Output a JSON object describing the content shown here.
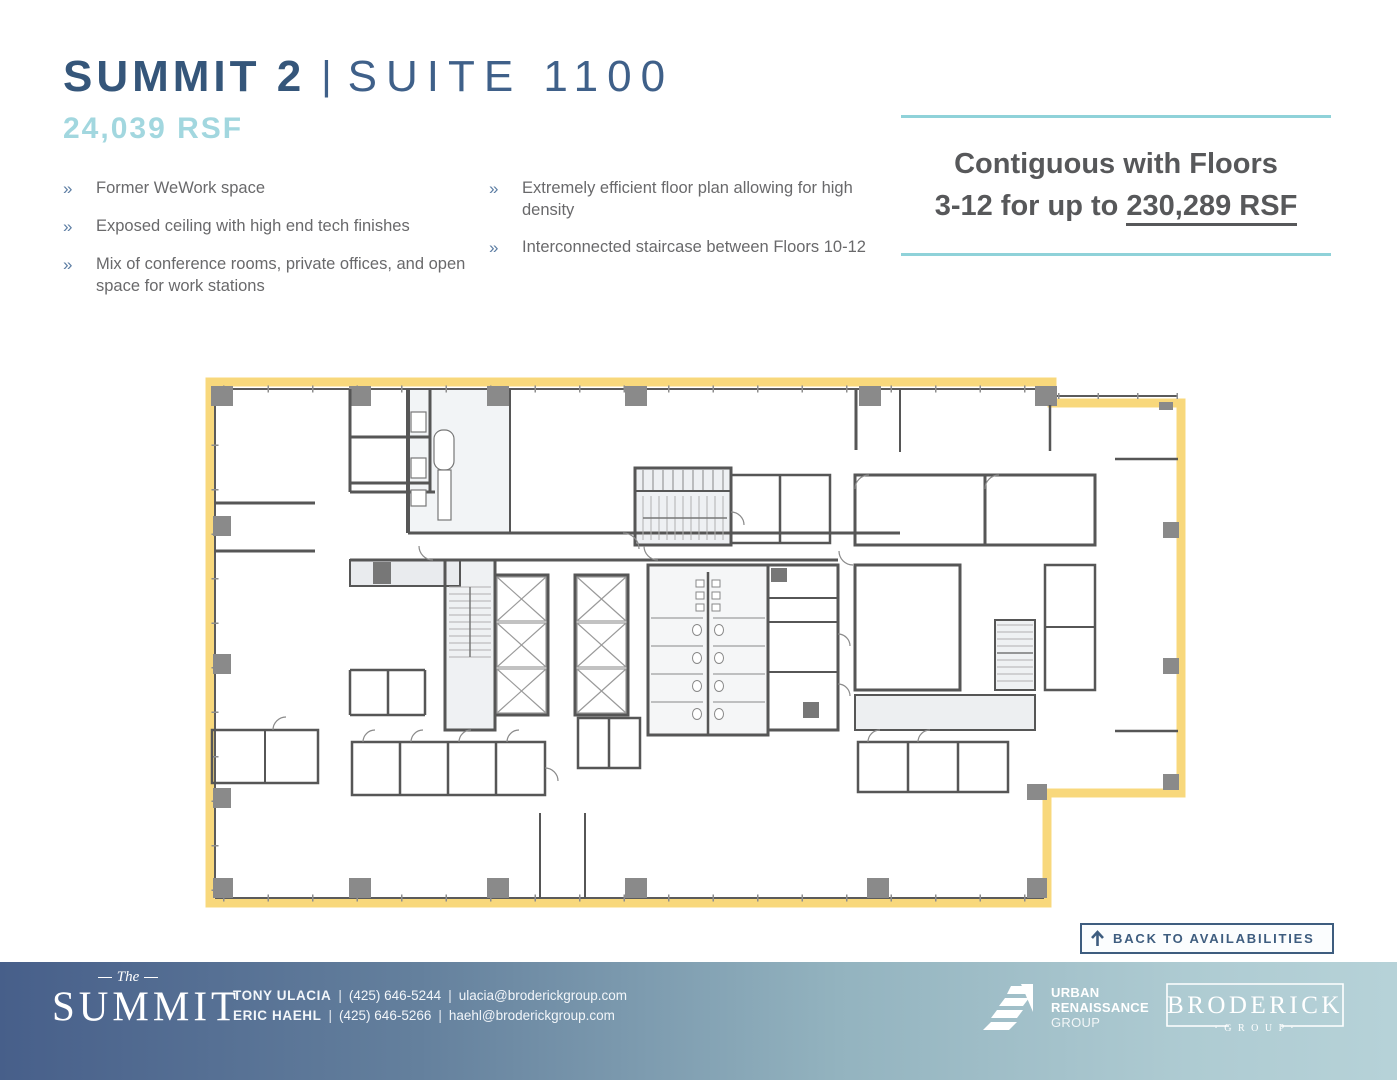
{
  "header": {
    "building": "SUMMIT 2",
    "separator": "|",
    "suite": "SUITE 1100",
    "size": "24,039 RSF"
  },
  "features": {
    "marker": "»",
    "left": [
      "Former WeWork space",
      "Exposed ceiling with high end tech finishes",
      "Mix of conference rooms, private offices, and open space for work stations"
    ],
    "right": [
      "Extremely efficient floor plan allowing for high density",
      "Interconnected staircase between Floors 10-12"
    ]
  },
  "callout": {
    "line1": "Contiguous with Floors",
    "line2_prefix": "3-12 for up to ",
    "line2_highlight": "230,289 RSF"
  },
  "floor_plan": {
    "highlight_color": "#f8d87c",
    "wall_color": "#565656",
    "column_color": "#8a8a8a"
  },
  "back_button": {
    "label": "BACK TO AVAILABILITIES"
  },
  "footer": {
    "separator": "|",
    "summit_logo": {
      "script": "The",
      "name": "SUMMIT"
    },
    "contacts": [
      {
        "name": "TONY ULACIA",
        "phone": "(425) 646-5244",
        "email": "ulacia@broderickgroup.com"
      },
      {
        "name": "ERIC HAEHL",
        "phone": "(425) 646-5266",
        "email": "haehl@broderickgroup.com"
      }
    ],
    "urban_renaissance_logo": {
      "line1": "URBAN",
      "line2": "RENAISSANCE",
      "line3": "GROUP"
    },
    "broderick_logo": {
      "name": "BRODERICK",
      "group": "· G R O U P ·"
    }
  },
  "colors": {
    "title_navy": "#35567a",
    "suite_navy": "#3f6089",
    "rsf_teal": "#a2d7df",
    "accent_teal": "#8fd2d9",
    "text_gray": "#69696b",
    "callout_gray": "#57585a",
    "bullet_blue": "#5c7da3",
    "button_navy": "#3e5d7f",
    "footer_gradient_start": "#475f8a",
    "footer_gradient_end": "#b6d2d8"
  }
}
